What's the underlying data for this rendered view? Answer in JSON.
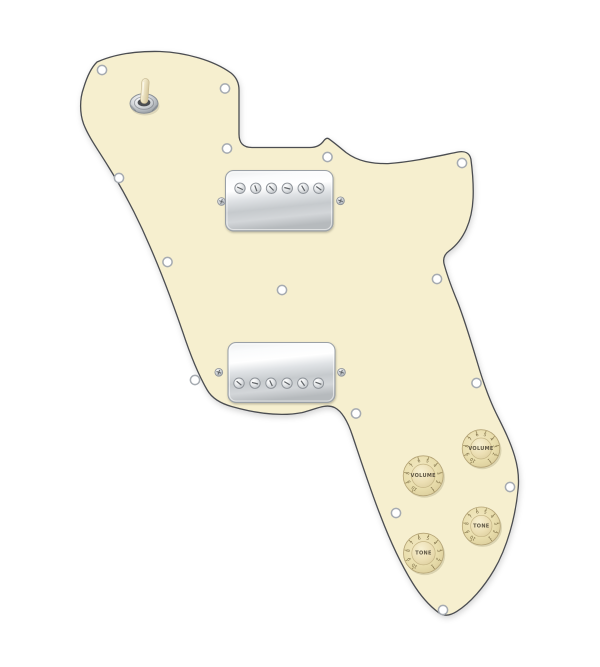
{
  "scene": {
    "subject": "Loaded 72 Deluxe style guitar pickguard, aged white, with two chrome humbucker pickups, 3-way toggle switch and four aged-white knobs",
    "background_color": "#ffffff"
  },
  "pickguard": {
    "fill": "#f6efcf",
    "edge_color": "#4b4d51",
    "outline_path": "M 97,62 C 115,54 138,51 160,51.5 C 185,52.5 213,60 231,73 C 236,77 239,83 239,90 L 239,134 C 239,143 243,147.5 252,147.5 L 310,147.5 C 317,147.5 321,145 324,140.5 C 325.2,139 326.8,137.4 328.8,138.8 C 334,142.5 340,147.5 346,152.5 C 358,161.5 372,163.8 388,163.6 C 412,162 438,156 458,152 C 465,150.6 469.6,153.2 470.9,159 C 472.6,172 473.6,186 473.1,198 C 472.1,221 464,240 449,251 C 444,254.6 442.4,259.2 444.5,265.5 C 448,278 452.6,290 457.6,302 C 465,321 471.2,342 477.5,363 C 482.5,380 488.2,397 496,413 C 503,427 510.2,441 514.6,456 C 517.6,466 519.2,477 518.2,488 C 515.6,517 507,548 494,570 C 484,587 470.4,603 456.6,611.6 C 450.2,615.6 444.2,616.8 438.6,612.6 C 429.2,605.6 420,595 412.6,583 C 399,561 388.6,537 380.6,516 C 371,491.6 362,464 352.6,436 C 348.2,422.6 342.6,411.6 334.6,407.6 C 325.2,403 314,410 302,412.6 C 280,416.8 254,412.8 232,406.6 C 221,403.6 212.2,398.6 207.2,390 C 197.6,373.6 190,354 182.6,331.6 C 172.6,302.6 162,274 150,246.6 C 137.6,217.6 123.2,190 108.6,167 C 98.2,150 88.6,137 83.6,124 C 79.6,113 79.6,99 83.6,88 C 86.6,78 91.2,67.6 97,62 Z"
  },
  "toggle_switch": {
    "name": "3-way toggle switch",
    "cx": 144,
    "cy": 103.5,
    "tip_color": "#f2e9cd",
    "lever_tilt_deg": 4
  },
  "pickups": [
    {
      "id": "neck",
      "label": "chrome humbucker (neck)",
      "x": 225.5,
      "y": 170.5,
      "width": 107.5,
      "height": 60.5,
      "pole_y": 188.3,
      "pole_xs": [
        240,
        255.8,
        271.5,
        287.3,
        303.2,
        318.8
      ],
      "pole_slot_angles": [
        25,
        70,
        45,
        15,
        60,
        35
      ],
      "mount_screws": [
        [
          221.5,
          201.5
        ],
        [
          340.5,
          200.8
        ]
      ]
    },
    {
      "id": "bridge",
      "label": "chrome humbucker (bridge)",
      "x": 228,
      "y": 342.5,
      "width": 107,
      "height": 60,
      "pole_y": 383.2,
      "pole_xs": [
        239,
        255,
        271,
        287,
        302.8,
        318.4
      ],
      "pole_slot_angles": [
        40,
        15,
        65,
        30,
        55,
        20
      ],
      "mount_screws": [
        [
          218.8,
          372.3
        ],
        [
          341.5,
          372.3
        ]
      ]
    }
  ],
  "knobs": [
    {
      "id": "volume-1",
      "label": "VOLUME",
      "cx": 481,
      "cy": 448.5,
      "r": 18.8
    },
    {
      "id": "volume-2",
      "label": "VOLUME",
      "cx": 423.2,
      "cy": 475.8,
      "r": 20
    },
    {
      "id": "tone-1",
      "label": "TONE",
      "cx": 481.3,
      "cy": 526,
      "r": 19
    },
    {
      "id": "tone-2",
      "label": "TONE",
      "cx": 423.5,
      "cy": 553.2,
      "r": 20
    }
  ],
  "knob_numbers": [
    "1",
    "2",
    "3",
    "4",
    "5",
    "6",
    "7",
    "8",
    "9",
    "10"
  ],
  "knob_number_start_angle": 145,
  "knob_number_step": -32.2,
  "knob_colors": {
    "skirt_edge": "#b5a476",
    "number": "#6e5f38",
    "label": "#5d5543"
  },
  "screw_holes": [
    [
      102,
      70
    ],
    [
      225,
      88.5
    ],
    [
      227,
      148.5
    ],
    [
      327.5,
      157
    ],
    [
      462,
      163
    ],
    [
      119,
      178
    ],
    [
      167.5,
      262
    ],
    [
      282,
      290
    ],
    [
      437,
      279
    ],
    [
      195,
      380
    ],
    [
      356,
      413.5
    ],
    [
      476.5,
      383
    ],
    [
      510,
      487
    ],
    [
      396,
      513
    ],
    [
      443,
      610
    ]
  ],
  "hole_style": {
    "fill": "#ffffff",
    "ring": "#a6abb1"
  }
}
